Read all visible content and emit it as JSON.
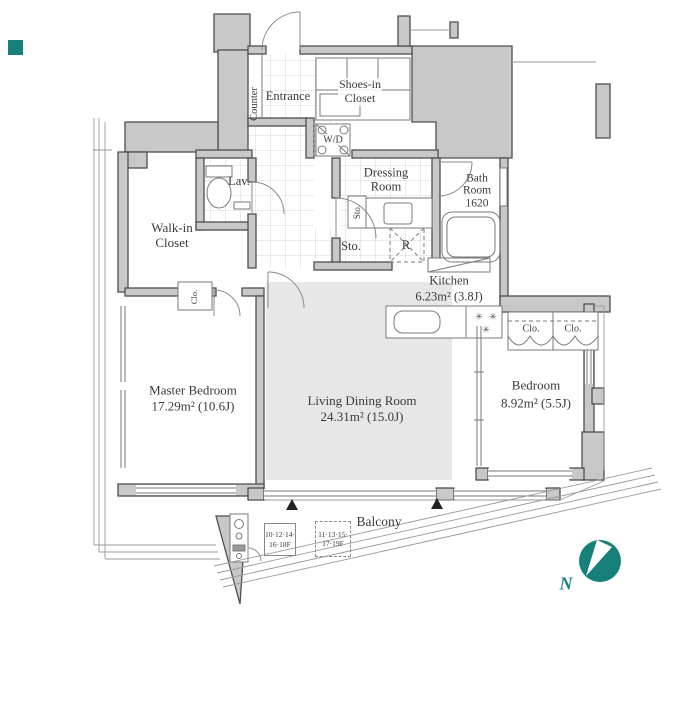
{
  "colors": {
    "wall_fill": "#c8c8c8",
    "wall_stroke": "#4f4f4f",
    "rug": "#e7e7e7",
    "teal": "#17807a",
    "text": "#3a3a3a"
  },
  "rooms": {
    "counter": {
      "label": "Counter"
    },
    "entrance": {
      "label": "Entrance"
    },
    "shoes_closet": {
      "line1": "Shoes-in",
      "line2": "Closet"
    },
    "wd": {
      "label": "W/D"
    },
    "lav": {
      "label": "Lav."
    },
    "dressing": {
      "line1": "Dressing",
      "line2": "Room"
    },
    "bath": {
      "line1": "Bath",
      "line2": "Room",
      "line3": "1620"
    },
    "sto_tall": {
      "label": "Sto."
    },
    "sto": {
      "label": "Sto."
    },
    "fridge": {
      "label": "R"
    },
    "walkin": {
      "line1": "Walk-in",
      "line2": "Closet"
    },
    "clo_walkin": {
      "label": "Clo."
    },
    "kitchen": {
      "name": "Kitchen",
      "area": "6.23m² (3.8J)"
    },
    "clo_left": {
      "label": "Clo."
    },
    "clo_right": {
      "label": "Clo."
    },
    "master": {
      "name": "Master Bedroom",
      "area": "17.29m² (10.6J)"
    },
    "living": {
      "name": "Living Dining Room",
      "area": "24.31m² (15.0J)"
    },
    "bedroom": {
      "name": "Bedroom",
      "area": "8.92m² (5.5J)"
    },
    "balcony": {
      "label": "Balcony"
    }
  },
  "annotations": {
    "floor_box_solid": {
      "line1": "10·12·14·",
      "line2": "16·18F"
    },
    "floor_box_dashed": {
      "line1": "11·13·15·",
      "line2": "17·19F"
    },
    "north": {
      "label": "N"
    },
    "burner_icon": "✳"
  }
}
